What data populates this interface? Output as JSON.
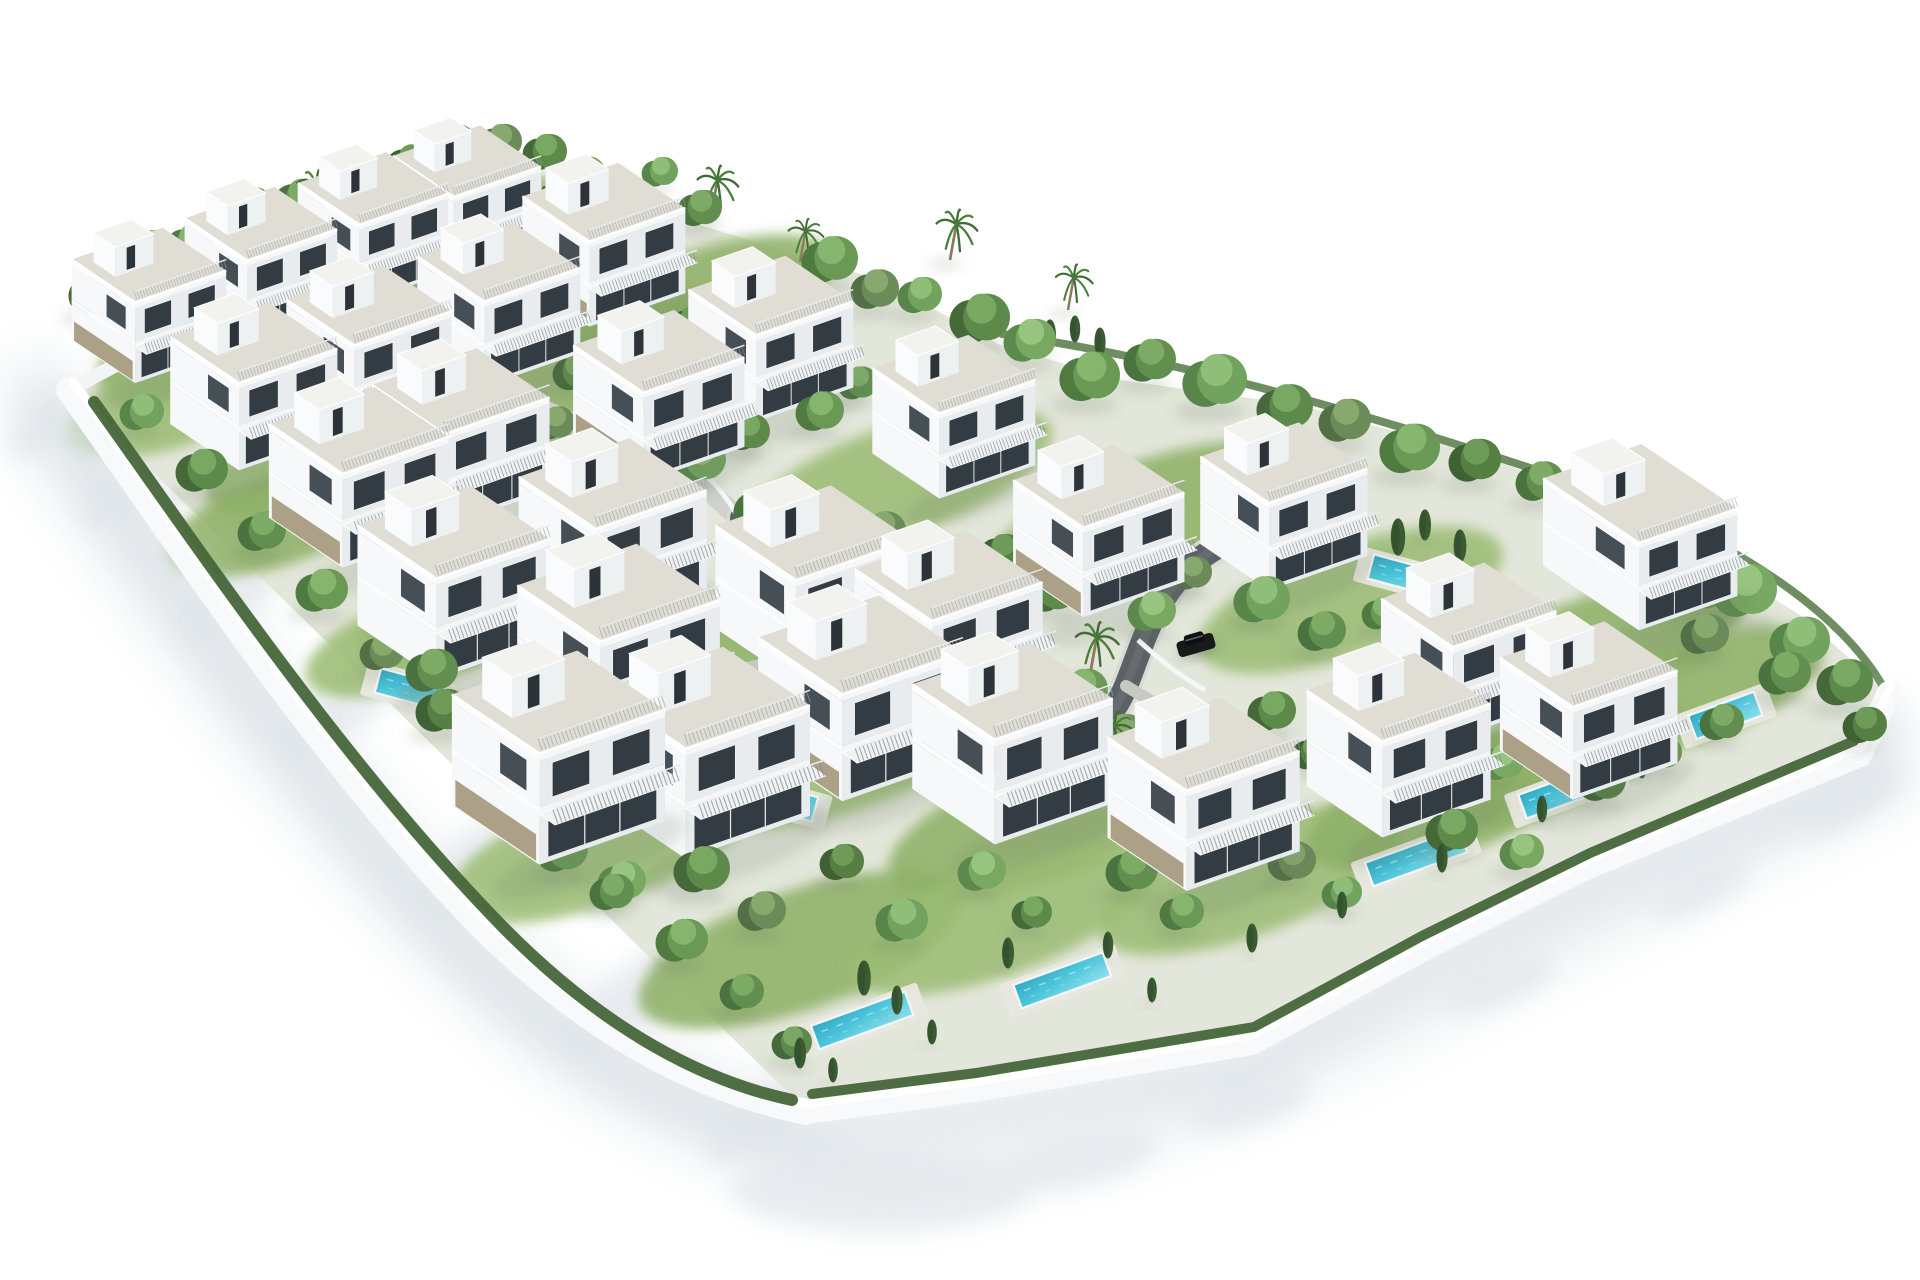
{
  "scene": {
    "title": "Aerial 3D render of villa development",
    "description": "Isometric photorealistic 3D architectural rendering of a gated residential development: rows of modern white three-storey villas with roof terraces, private turquoise pools, lush green trees and palms, a curving dark internal road with two parked cars, all enclosed by a white perimeter wall casting soft shadows on a pure white background",
    "width": 1920,
    "height": 1280,
    "background": "#ffffff"
  },
  "palette": {
    "faceL": "#f6f8f9",
    "faceR": "#e8ecee",
    "glass": "#333c42",
    "stone": "#a89b80",
    "slabL": "#fbfcfd",
    "slabR": "#f3f5f6",
    "deck": "#dfddd4",
    "boxR": "#eef1f2",
    "boxL": "#f9fbfc",
    "boxTop": "#f2f3ef",
    "rail": "#848d93",
    "railTop": "#e8ebed",
    "poolDeep": "#2fa8c4",
    "pool": "#4cc4da",
    "poolLight": "#8fe2ef",
    "poolDeck": "#e9e8e0",
    "road": "#5b6165",
    "roadSheen": "#6e7478",
    "curb": "#d8dbd8",
    "street": "#cfd1cc",
    "driveway": "#c6c8c3",
    "wall": "#f7f9fa",
    "wallHi": "#ffffff",
    "wallShadow": "#dfe5e9",
    "ground": "#e3e6da",
    "hedge": "#46663a",
    "hedgeLight": "#557a45",
    "grassA": "#8fb168",
    "grassB": "#9cbd74",
    "trunk": "#8a7a5e",
    "palmFrond": "#4c7f3e",
    "palmFrondDark": "#3f6b34",
    "cypress": "#3b5c33",
    "cypressDark": "#2f4b29",
    "treeShadow": "rgba(95,110,95,0.18)",
    "villaShadow": "rgba(100,112,100,0.16)",
    "outerShadow": "#e9edef",
    "outerBlob": "#e2e7eb",
    "greens": [
      [
        "#46693a",
        "#5d8a4a",
        "#79a862"
      ],
      [
        "#4f7a40",
        "#699955",
        "#86b56d"
      ],
      [
        "#57854a",
        "#72a35e",
        "#8fbe78"
      ],
      [
        "#3f6234",
        "#567f44",
        "#6f9b58"
      ],
      [
        "#5c8a4c",
        "#78a861",
        "#97c47e"
      ],
      [
        "#4a7340",
        "#628f50",
        "#7dab66"
      ],
      [
        "#526f45",
        "#6b8b58",
        "#87a96e"
      ],
      [
        "#43703a",
        "#5f944c",
        "#7cb263"
      ]
    ]
  },
  "estate": {
    "ground": [
      [
        69,
        390
      ],
      [
        230,
        300
      ],
      [
        420,
        230
      ],
      [
        520,
        185
      ],
      [
        560,
        170
      ],
      [
        640,
        215
      ],
      [
        700,
        225
      ],
      [
        880,
        280
      ],
      [
        1000,
        345
      ],
      [
        1120,
        380
      ],
      [
        1300,
        405
      ],
      [
        1480,
        455
      ],
      [
        1640,
        515
      ],
      [
        1800,
        615
      ],
      [
        1888,
        692
      ],
      [
        1858,
        754
      ],
      [
        1586,
        866
      ],
      [
        1418,
        950
      ],
      [
        1250,
        1042
      ],
      [
        974,
        1089
      ],
      [
        806,
        1110
      ]
    ],
    "wall_sw": "M 69,390 C 180,545 320,760 480,925 C 592,1036 700,1090 806,1112",
    "wall_se": "M 806,1112 L 974,1090 L 1252,1043 L 1420,951 L 1588,867 L 1860,755 L 1889,693",
    "wall_nw": "M 69,390 L 235,302",
    "hedge_sw": "M 94,402 C 200,550 342,762 502,926 C 606,1032 706,1082 792,1100",
    "hedge_se": "M 812,1094 L 976,1073 L 1254,1027 L 1422,936 L 1590,853 L 1854,741",
    "hedge_nw": "M 74,386 L 420,222 L 558,146",
    "hedge_ne": "M 1002,334 C 1200,362 1420,430 1620,498 C 1762,556 1846,622 1884,688"
  },
  "roads": {
    "street_upper": "M 348,320 L 455,370 L 562,418 L 652,460 L 712,494 L 748,526",
    "main": "M 742,518 C 775,558 795,600 815,650 C 843,708 902,744 976,758 C 1052,772 1106,736 1126,686 C 1144,641 1154,598 1194,563 C 1232,533 1282,516 1332,499",
    "driveway": "M 815,650 C 780,662 740,672 690,680",
    "driveway2": "M 1126,686 C 1152,702 1172,714 1192,726"
  },
  "villas": [
    {
      "x": 150,
      "y": 318,
      "s": 0.74,
      "stone": 1
    },
    {
      "x": 262,
      "y": 276,
      "s": 0.73,
      "stone": 0
    },
    {
      "x": 374,
      "y": 240,
      "s": 0.72,
      "stone": 1
    },
    {
      "x": 468,
      "y": 212,
      "s": 0.71,
      "stone": 0
    },
    {
      "x": 255,
      "y": 400,
      "s": 0.8,
      "stone": 0
    },
    {
      "x": 370,
      "y": 362,
      "s": 0.79,
      "stone": 1
    },
    {
      "x": 500,
      "y": 318,
      "s": 0.78,
      "stone": 0
    },
    {
      "x": 605,
      "y": 258,
      "s": 0.78,
      "stone": 1
    },
    {
      "x": 360,
      "y": 492,
      "s": 0.86,
      "stone": 1
    },
    {
      "x": 462,
      "y": 452,
      "s": 0.85,
      "stone": 0
    },
    {
      "x": 660,
      "y": 410,
      "s": 0.82,
      "stone": 1
    },
    {
      "x": 772,
      "y": 352,
      "s": 0.79,
      "stone": 0
    },
    {
      "x": 455,
      "y": 598,
      "s": 0.92,
      "stone": 0
    },
    {
      "x": 614,
      "y": 548,
      "s": 0.9,
      "stone": 1
    },
    {
      "x": 955,
      "y": 430,
      "s": 0.78,
      "stone": 0
    },
    {
      "x": 1100,
      "y": 545,
      "s": 0.82,
      "stone": 1
    },
    {
      "x": 1285,
      "y": 520,
      "s": 0.8,
      "stone": 0
    },
    {
      "x": 1655,
      "y": 560,
      "s": 0.8,
      "stone": 0,
      "deep": 1
    },
    {
      "x": 1470,
      "y": 665,
      "s": 0.84,
      "stone": 1
    },
    {
      "x": 620,
      "y": 662,
      "s": 0.97,
      "stone": 1
    },
    {
      "x": 815,
      "y": 600,
      "s": 0.94,
      "stone": 0
    },
    {
      "x": 950,
      "y": 640,
      "s": 0.9,
      "stone": 1
    },
    {
      "x": 560,
      "y": 775,
      "s": 1.02,
      "stone": 1
    },
    {
      "x": 706,
      "y": 770,
      "s": 1.01,
      "stone": 0
    },
    {
      "x": 862,
      "y": 715,
      "s": 0.98,
      "stone": 1
    },
    {
      "x": 1014,
      "y": 760,
      "s": 0.96,
      "stone": 0
    },
    {
      "x": 1205,
      "y": 810,
      "s": 0.92,
      "stone": 1
    },
    {
      "x": 1400,
      "y": 760,
      "s": 0.88,
      "stone": 0
    },
    {
      "x": 1590,
      "y": 725,
      "s": 0.85,
      "stone": 1
    }
  ],
  "pools": [
    {
      "x": 420,
      "y": 380,
      "len": 70,
      "dir": "d"
    },
    {
      "x": 636,
      "y": 466,
      "len": 95,
      "dir": "d"
    },
    {
      "x": 455,
      "y": 492,
      "len": 58,
      "dir": "d"
    },
    {
      "x": 408,
      "y": 688,
      "len": 62,
      "dir": "d"
    },
    {
      "x": 830,
      "y": 585,
      "len": 95,
      "dir": "d"
    },
    {
      "x": 1035,
      "y": 700,
      "len": 95,
      "dir": "d"
    },
    {
      "x": 1412,
      "y": 577,
      "len": 85,
      "dir": "d"
    },
    {
      "x": 774,
      "y": 798,
      "len": 85,
      "dir": "d"
    },
    {
      "x": 862,
      "y": 1020,
      "len": 100,
      "dir": "u"
    },
    {
      "x": 1062,
      "y": 980,
      "len": 95,
      "dir": "u"
    },
    {
      "x": 1416,
      "y": 857,
      "len": 100,
      "dir": "u"
    },
    {
      "x": 1567,
      "y": 790,
      "len": 95,
      "dir": "u"
    },
    {
      "x": 1725,
      "y": 715,
      "len": 70,
      "dir": "u"
    }
  ],
  "trees": [
    [
      95,
      305,
      26,
      0
    ],
    [
      150,
      258,
      22,
      4
    ],
    [
      190,
      255,
      24,
      1
    ],
    [
      250,
      215,
      22,
      2
    ],
    [
      300,
      212,
      26,
      5
    ],
    [
      355,
      178,
      22,
      1
    ],
    [
      410,
      175,
      24,
      3
    ],
    [
      455,
      150,
      20,
      2
    ],
    [
      500,
      152,
      22,
      6
    ],
    [
      545,
      162,
      22,
      0
    ],
    [
      585,
      182,
      20,
      4
    ],
    [
      640,
      252,
      26,
      1
    ],
    [
      700,
      218,
      22,
      5
    ],
    [
      660,
      180,
      18,
      2
    ],
    [
      830,
      272,
      28,
      1
    ],
    [
      875,
      300,
      24,
      6
    ],
    [
      920,
      305,
      22,
      2
    ],
    [
      980,
      332,
      30,
      0
    ],
    [
      1030,
      352,
      26,
      4
    ],
    [
      1090,
      390,
      30,
      1
    ],
    [
      1150,
      372,
      26,
      5
    ],
    [
      1215,
      395,
      32,
      2
    ],
    [
      1285,
      420,
      28,
      0
    ],
    [
      1345,
      432,
      26,
      6
    ],
    [
      1410,
      462,
      30,
      1
    ],
    [
      1475,
      472,
      26,
      3
    ],
    [
      1540,
      492,
      24,
      5
    ],
    [
      1595,
      522,
      22,
      0
    ],
    [
      1650,
      520,
      20,
      2
    ],
    [
      1700,
      600,
      30,
      1
    ],
    [
      1745,
      605,
      32,
      4
    ],
    [
      1800,
      655,
      30,
      2
    ],
    [
      1845,
      695,
      28,
      0
    ],
    [
      1785,
      685,
      26,
      5
    ],
    [
      1705,
      645,
      24,
      6
    ],
    [
      1865,
      735,
      22,
      3
    ],
    [
      1680,
      582,
      24,
      0
    ],
    [
      1640,
      560,
      20,
      2
    ],
    [
      205,
      335,
      22,
      3
    ],
    [
      315,
      295,
      24,
      0
    ],
    [
      425,
      258,
      22,
      6
    ],
    [
      208,
      388,
      18,
      5
    ],
    [
      318,
      352,
      20,
      2
    ],
    [
      430,
      315,
      18,
      1
    ],
    [
      540,
      285,
      18,
      4
    ],
    [
      575,
      382,
      22,
      0
    ],
    [
      690,
      332,
      20,
      3
    ],
    [
      735,
      302,
      18,
      6
    ],
    [
      820,
      422,
      24,
      1
    ],
    [
      858,
      392,
      20,
      5
    ],
    [
      700,
      472,
      26,
      2
    ],
    [
      748,
      442,
      22,
      0
    ],
    [
      555,
      432,
      20,
      6
    ],
    [
      505,
      402,
      18,
      3
    ],
    [
      612,
      472,
      22,
      4
    ],
    [
      548,
      522,
      24,
      1
    ],
    [
      658,
      547,
      20,
      0
    ],
    [
      762,
      522,
      28,
      5
    ],
    [
      802,
      562,
      22,
      2
    ],
    [
      882,
      542,
      24,
      6
    ],
    [
      912,
      592,
      20,
      1
    ],
    [
      1002,
      562,
      22,
      3
    ],
    [
      1052,
      602,
      26,
      0
    ],
    [
      1152,
      622,
      24,
      4
    ],
    [
      1192,
      582,
      20,
      6
    ],
    [
      1262,
      612,
      28,
      2
    ],
    [
      1322,
      642,
      24,
      5
    ],
    [
      1382,
      622,
      20,
      1
    ],
    [
      1432,
      682,
      26,
      0
    ],
    [
      1532,
      702,
      24,
      3
    ],
    [
      1582,
      672,
      20,
      6
    ],
    [
      1622,
      702,
      22,
      4
    ],
    [
      502,
      642,
      24,
      2
    ],
    [
      432,
      682,
      26,
      5
    ],
    [
      392,
      622,
      20,
      0
    ],
    [
      482,
      722,
      22,
      1
    ],
    [
      642,
      732,
      24,
      6
    ],
    [
      592,
      702,
      20,
      3
    ],
    [
      757,
      702,
      26,
      4
    ],
    [
      802,
      722,
      22,
      0
    ],
    [
      922,
      702,
      24,
      2
    ],
    [
      962,
      732,
      20,
      5
    ],
    [
      1082,
      702,
      26,
      1
    ],
    [
      1122,
      742,
      22,
      6
    ],
    [
      1272,
      722,
      24,
      0
    ],
    [
      1312,
      762,
      20,
      3
    ],
    [
      1462,
      742,
      26,
      2
    ],
    [
      1502,
      772,
      22,
      4
    ],
    [
      562,
      862,
      26,
      1
    ],
    [
      612,
      902,
      22,
      5
    ],
    [
      702,
      882,
      28,
      0
    ],
    [
      762,
      922,
      24,
      6
    ],
    [
      842,
      872,
      22,
      3
    ],
    [
      902,
      932,
      26,
      2
    ],
    [
      982,
      882,
      24,
      4
    ],
    [
      1032,
      922,
      20,
      0
    ],
    [
      1132,
      882,
      26,
      5
    ],
    [
      1182,
      922,
      22,
      1
    ],
    [
      1292,
      872,
      24,
      6
    ],
    [
      1342,
      902,
      20,
      2
    ],
    [
      1452,
      842,
      26,
      0
    ],
    [
      1522,
      862,
      22,
      4
    ],
    [
      1602,
      792,
      24,
      3
    ],
    [
      1662,
      762,
      20,
      1
    ],
    [
      1722,
      732,
      22,
      5
    ],
    [
      142,
      422,
      22,
      2
    ],
    [
      202,
      482,
      26,
      0
    ],
    [
      262,
      542,
      24,
      5
    ],
    [
      322,
      602,
      26,
      1
    ],
    [
      382,
      662,
      22,
      6
    ],
    [
      442,
      722,
      26,
      3
    ],
    [
      502,
      782,
      24,
      0
    ],
    [
      562,
      832,
      20,
      2
    ],
    [
      622,
      892,
      24,
      4
    ],
    [
      682,
      952,
      26,
      1
    ],
    [
      742,
      1002,
      22,
      5
    ],
    [
      792,
      1052,
      20,
      0
    ]
  ],
  "palms": [
    [
      310,
      218,
      1.0
    ],
    [
      415,
      250,
      0.9
    ],
    [
      535,
      235,
      1.0
    ],
    [
      594,
      210,
      0.85
    ],
    [
      711,
      216,
      1.05
    ],
    [
      800,
      262,
      0.9
    ],
    [
      950,
      260,
      1.05
    ],
    [
      1068,
      310,
      0.95
    ],
    [
      1090,
      675,
      1.1
    ],
    [
      1015,
      798,
      1.15
    ],
    [
      1108,
      762,
      1.05
    ]
  ],
  "cypresses": [
    [
      800,
      1068,
      30
    ],
    [
      833,
      1082,
      24
    ],
    [
      864,
      995,
      34
    ],
    [
      897,
      1014,
      28
    ],
    [
      932,
      1044,
      24
    ],
    [
      1008,
      968,
      30
    ],
    [
      1108,
      958,
      26
    ],
    [
      1152,
      1002,
      24
    ],
    [
      1252,
      952,
      28
    ],
    [
      1342,
      918,
      26
    ],
    [
      1442,
      872,
      28
    ],
    [
      1542,
      822,
      26
    ],
    [
      1642,
      778,
      24
    ],
    [
      905,
      618,
      30
    ],
    [
      873,
      600,
      22
    ],
    [
      655,
      456,
      24
    ],
    [
      624,
      438,
      19
    ],
    [
      1180,
      830,
      26
    ],
    [
      1398,
      555,
      36
    ],
    [
      1425,
      540,
      30
    ],
    [
      1460,
      562,
      32
    ],
    [
      1340,
      545,
      28
    ],
    [
      1050,
      350,
      30
    ],
    [
      1075,
      342,
      26
    ],
    [
      1100,
      356,
      28
    ]
  ],
  "grass": [
    [
      250,
      330,
      160,
      60,
      -19
    ],
    [
      420,
      260,
      180,
      60,
      -19
    ],
    [
      600,
      370,
      160,
      60,
      -19
    ],
    [
      350,
      450,
      150,
      55,
      -19
    ],
    [
      700,
      300,
      140,
      50,
      -19
    ],
    [
      900,
      480,
      160,
      55,
      -19
    ],
    [
      1150,
      520,
      170,
      60,
      -19
    ],
    [
      1350,
      600,
      160,
      55,
      -19
    ],
    [
      1600,
      650,
      150,
      55,
      -19
    ],
    [
      500,
      600,
      150,
      55,
      -19
    ],
    [
      650,
      680,
      150,
      55,
      -19
    ],
    [
      850,
      750,
      170,
      60,
      -19
    ],
    [
      1050,
      820,
      170,
      60,
      -19
    ],
    [
      1250,
      880,
      160,
      55,
      -20
    ],
    [
      1450,
      800,
      150,
      55,
      -20
    ],
    [
      600,
      850,
      160,
      55,
      -19
    ],
    [
      800,
      950,
      170,
      60,
      -19
    ],
    [
      1000,
      920,
      160,
      55,
      -20
    ],
    [
      1550,
      760,
      140,
      50,
      -20
    ],
    [
      180,
      400,
      120,
      45,
      -19
    ],
    [
      280,
      520,
      120,
      45,
      -19
    ],
    [
      420,
      640,
      120,
      45,
      -19
    ],
    [
      1700,
      690,
      130,
      50,
      -20
    ]
  ],
  "cars": [
    {
      "x": 848,
      "y": 624,
      "rot": -24,
      "body": "#4f4843",
      "roof": "#2e2a27"
    },
    {
      "x": 1196,
      "y": 645,
      "rot": -16,
      "body": "#17191b",
      "roof": "#0d0f10"
    }
  ],
  "outer_shadows": {
    "streaks": [
      {
        "path": "M 40,400 C 150,560 300,780 470,950 C 580,1060 690,1115 790,1140",
        "w": 85,
        "blur": 26,
        "op": 0.9
      },
      {
        "path": "M 850,1168 C 1020,1168 1250,1090 1430,995 C 1610,905 1780,820 1892,770",
        "w": 64,
        "blur": 24,
        "op": 0.85
      }
    ],
    "blobs": [
      [
        130,
        485,
        60,
        22,
        -38
      ],
      [
        235,
        595,
        70,
        25,
        -38
      ],
      [
        345,
        705,
        78,
        27,
        -38
      ],
      [
        485,
        855,
        88,
        30,
        -38
      ],
      [
        635,
        995,
        88,
        30,
        -38
      ],
      [
        765,
        1115,
        72,
        25,
        -38
      ],
      [
        880,
        1190,
        150,
        42,
        0
      ],
      [
        1080,
        1160,
        80,
        26,
        -12
      ],
      [
        1250,
        1105,
        65,
        22,
        -16
      ],
      [
        1500,
        985,
        60,
        20,
        -22
      ],
      [
        1700,
        890,
        55,
        20,
        -26
      ],
      [
        1850,
        800,
        60,
        22,
        -30
      ],
      [
        40,
        430,
        40,
        16,
        -38
      ]
    ]
  }
}
